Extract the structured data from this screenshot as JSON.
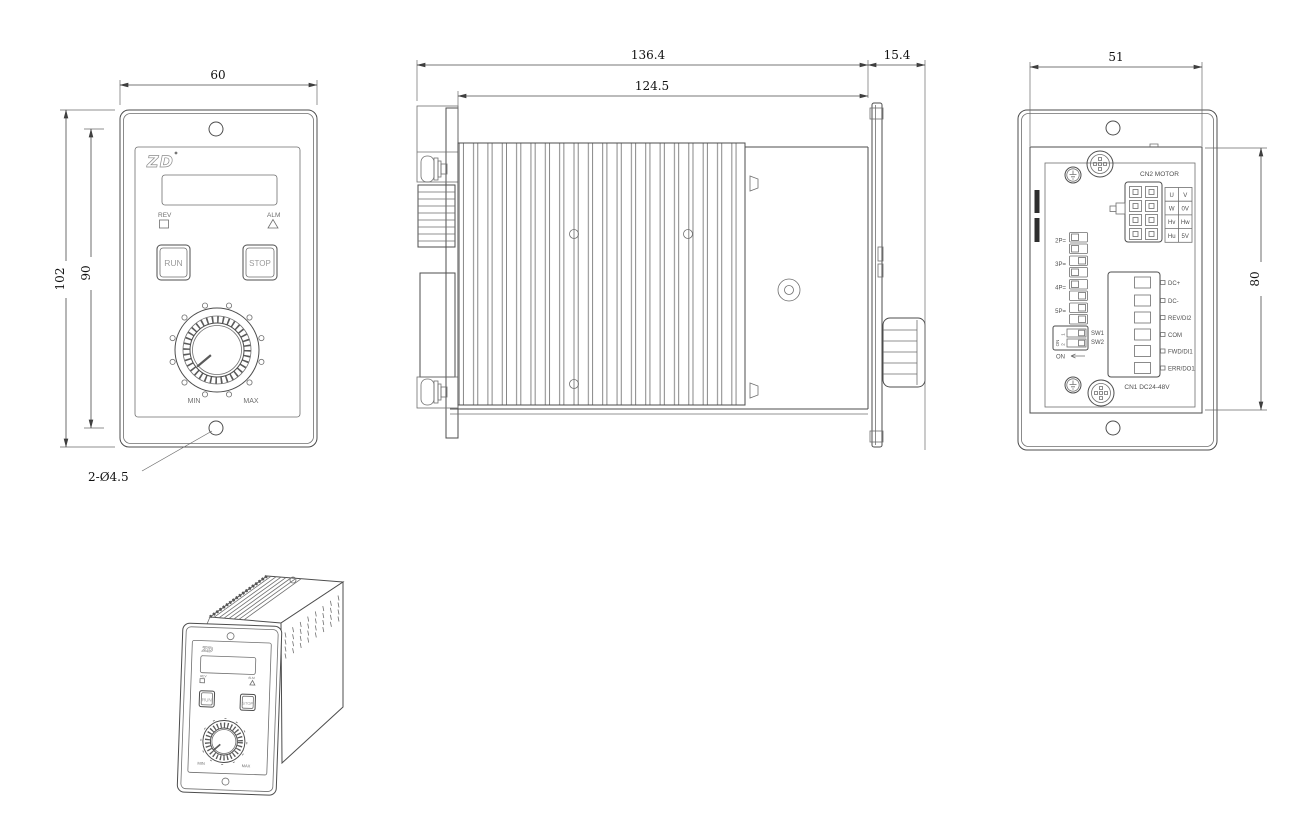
{
  "front_view": {
    "dims": {
      "width": "60",
      "height_overall": "102",
      "hole_spacing": "90"
    },
    "hole_callout": "2-Ø4.5",
    "panel": {
      "logo": "ZD",
      "rev": "REV",
      "alm": "ALM",
      "run": "RUN",
      "stop": "STOP",
      "min": "MIN",
      "max": "MAX"
    }
  },
  "side_view": {
    "dims": {
      "overall_depth": "136.4",
      "body_depth": "124.5",
      "front_depth": "15.4"
    }
  },
  "rear_view": {
    "dims": {
      "body_width": "51",
      "body_height": "80"
    },
    "cn2_label": "CN2 MOTOR",
    "cn2_pins": [
      [
        "U",
        "V"
      ],
      [
        "W",
        "0V"
      ],
      [
        "Hv",
        "Hw"
      ],
      [
        "Hu",
        "5V"
      ]
    ],
    "dip_rows": [
      "2P=",
      "3P=",
      "4P=",
      "5P="
    ],
    "sw_labels": {
      "sw1": "SW1",
      "sw2": "SW2",
      "num1": "1",
      "num2": "2",
      "on_inside": "ON",
      "on": "ON"
    },
    "cn1_terminals": [
      "DC+",
      "DC-",
      "REV/DI2",
      "COM",
      "FWD/DI1",
      "ERR/DO1"
    ],
    "cn1_label": "CN1 DC24-48V"
  },
  "iso_view": {
    "logo": "ZD",
    "rev": "REV",
    "alm": "ALM",
    "run": "RUN",
    "stop": "STOP",
    "min": "MIN",
    "max": "MAX"
  }
}
